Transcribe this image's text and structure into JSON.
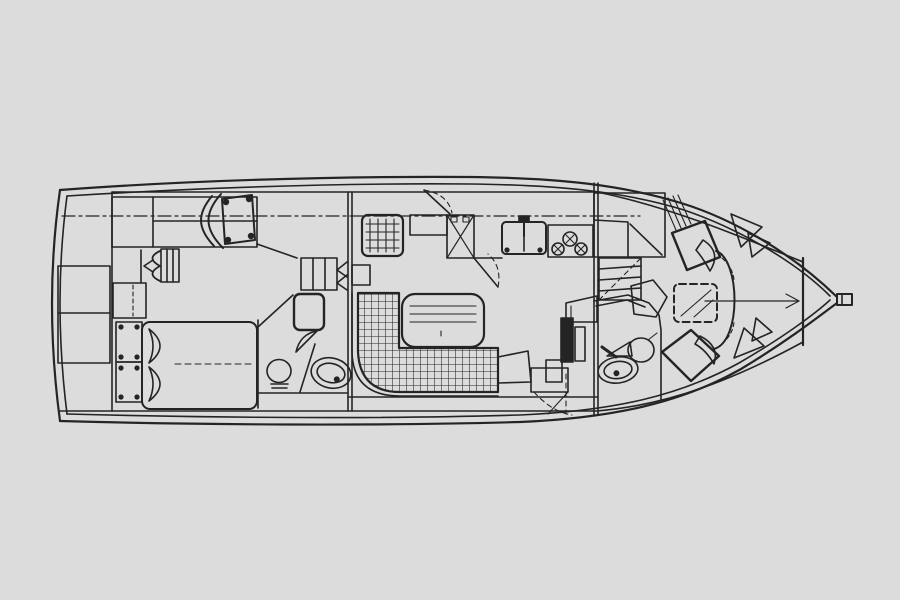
{
  "title": "Motor yacht interior deck plan (line drawing, bow to the right)",
  "colors": {
    "background": "#dcdcdc",
    "ink": "#242424"
  },
  "drawing": {
    "type": "floorplan",
    "orientation": "bow-right",
    "compartments": [
      {
        "name": "aft-deck",
        "fixtures": [
          "transom-locker"
        ]
      },
      {
        "name": "aft-cabin",
        "fixtures": [
          "side-cabinet",
          "vanity-chair",
          "wardrobe",
          "dresser",
          "nightstand",
          "step-boxes",
          "double-berth",
          "pillows"
        ]
      },
      {
        "name": "aft-head",
        "fixtures": [
          "shower-unit",
          "toilet",
          "oval-sink",
          "door-swing"
        ]
      },
      {
        "name": "salon",
        "fixtures": [
          "l-shaped-settee",
          "dinette-table",
          "companionway-steps",
          "side-door-swing"
        ]
      },
      {
        "name": "galley",
        "fixtures": [
          "grid-cabinet",
          "counter-shelf",
          "refrigerator",
          "double-sink",
          "three-burner-stove"
        ]
      },
      {
        "name": "lower-helm-passage",
        "fixtures": [
          "black-door-panel",
          "console-panel",
          "storage-boxes"
        ]
      },
      {
        "name": "forward-companionway",
        "fixtures": [
          "cabinet-block",
          "steps-down"
        ]
      },
      {
        "name": "forward-head",
        "fixtures": [
          "shower-enclosure",
          "toilet",
          "oval-sink"
        ]
      },
      {
        "name": "forward-cabin",
        "fixtures": [
          "angled-berth-port",
          "angled-berth-starboard",
          "overhead-hatch",
          "corner-seat",
          "hull-shelves",
          "berth-foot-curve"
        ]
      },
      {
        "name": "bow",
        "fixtures": [
          "collision-bulkhead",
          "centerline-arrow",
          "bow-fitting"
        ]
      }
    ],
    "linework": {
      "hull_outline": "double line, pointed bow right, rounded transom left",
      "centerline_upper_dashdot_y": 216,
      "centerline_bow_y": 301
    }
  }
}
